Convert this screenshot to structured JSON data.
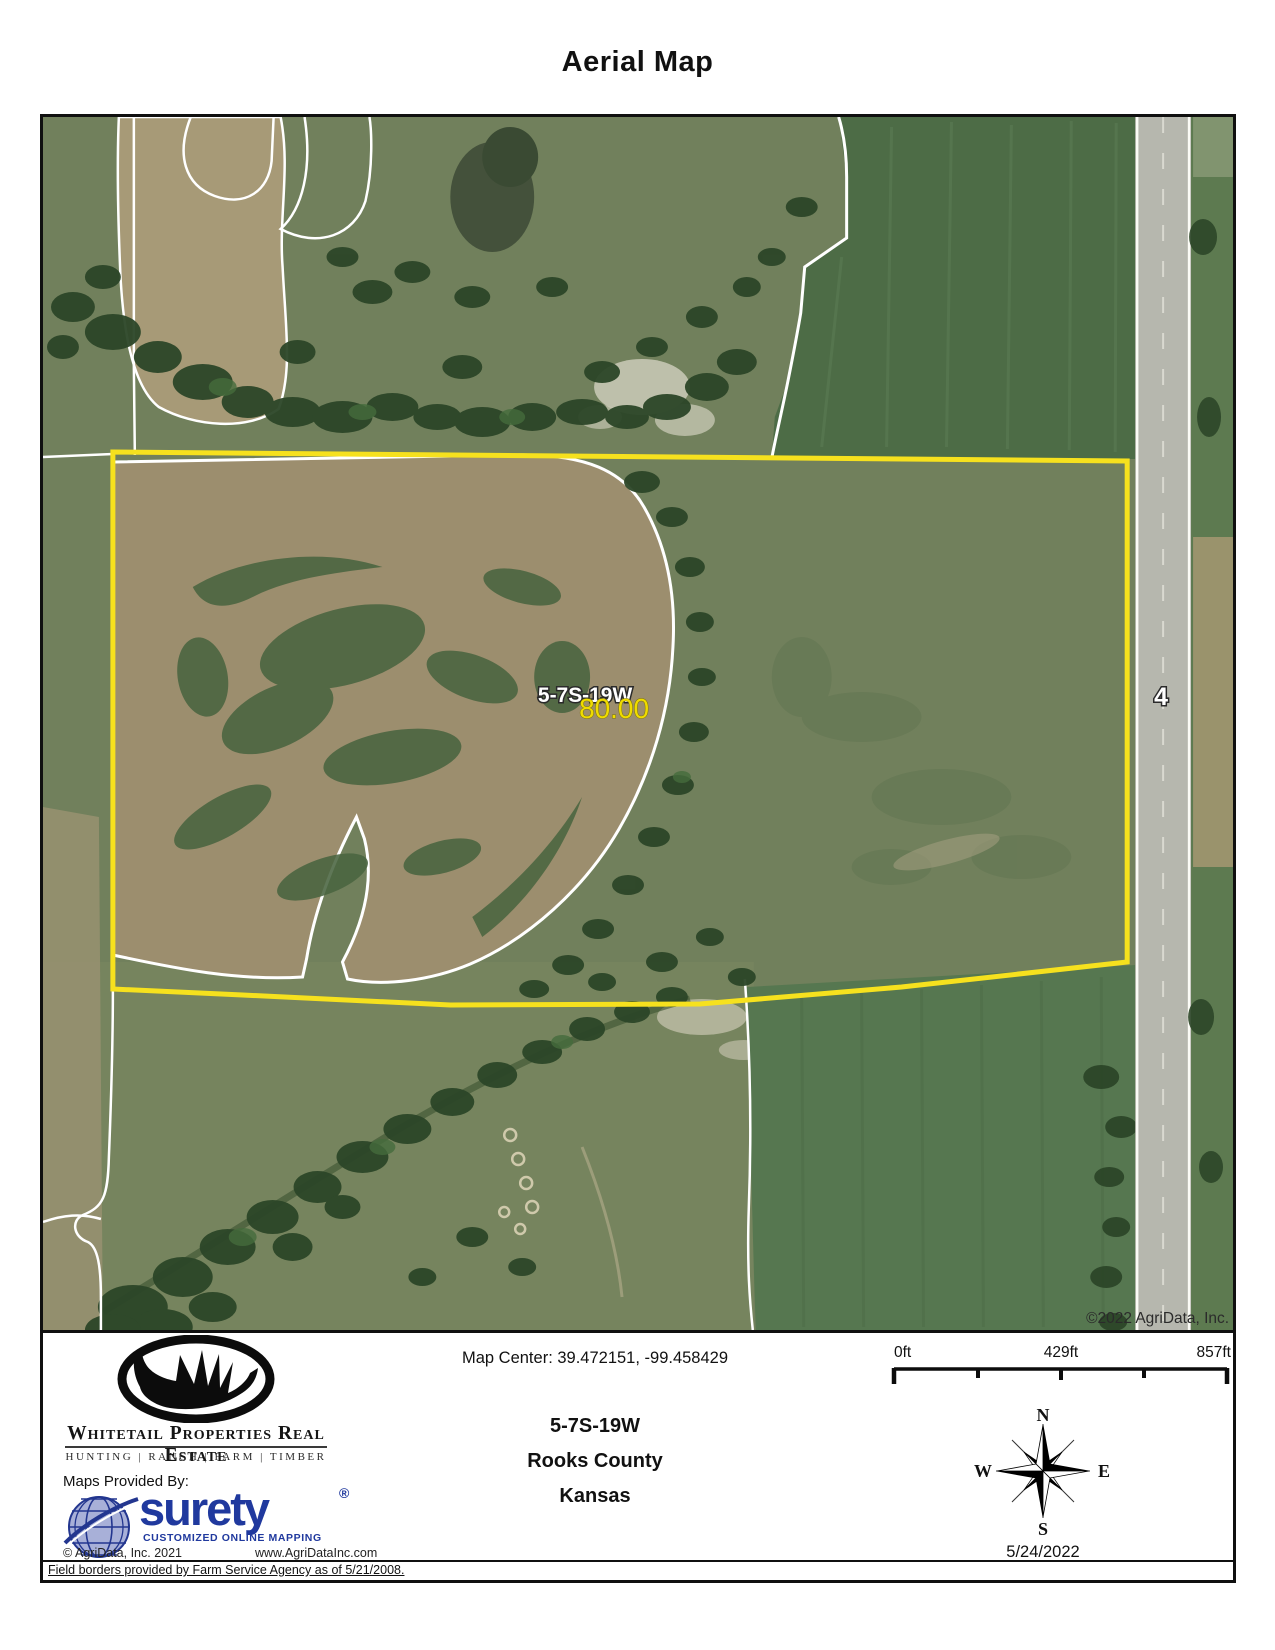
{
  "title": "Aerial Map",
  "map": {
    "section_label": "5-7S-19W",
    "acreage_label": "80.00",
    "road_label": "4",
    "imagery_copyright": "©2022 AgriData, Inc.",
    "colors": {
      "boundary_yellow": "#F6E11E",
      "field_border_white": "#FFFFFF",
      "acreage_text_yellow": "#F0DC00"
    }
  },
  "footer": {
    "brand": {
      "name": "Whitetail Properties Real Estate",
      "tagline": "HUNTING | RANCH | FARM | TIMBER"
    },
    "surety": {
      "provided_by": "Maps Provided By:",
      "name": "surety",
      "registered_mark": "®",
      "tagline": "CUSTOMIZED ONLINE MAPPING",
      "copyright": "© AgriData, Inc. 2021",
      "website": "www.AgriDataInc.com",
      "brand_blue": "#20399E"
    },
    "location": {
      "map_center": "Map Center: 39.472151, -99.458429",
      "section": "5-7S-19W",
      "county": "Rooks County",
      "state": "Kansas"
    },
    "scalebar": {
      "labels": [
        "0ft",
        "429ft",
        "857ft"
      ]
    },
    "compass": {
      "north": "N",
      "east": "E",
      "south": "S",
      "west": "W",
      "date": "5/24/2022"
    },
    "field_note": "Field borders provided by Farm Service Agency as of 5/21/2008."
  }
}
